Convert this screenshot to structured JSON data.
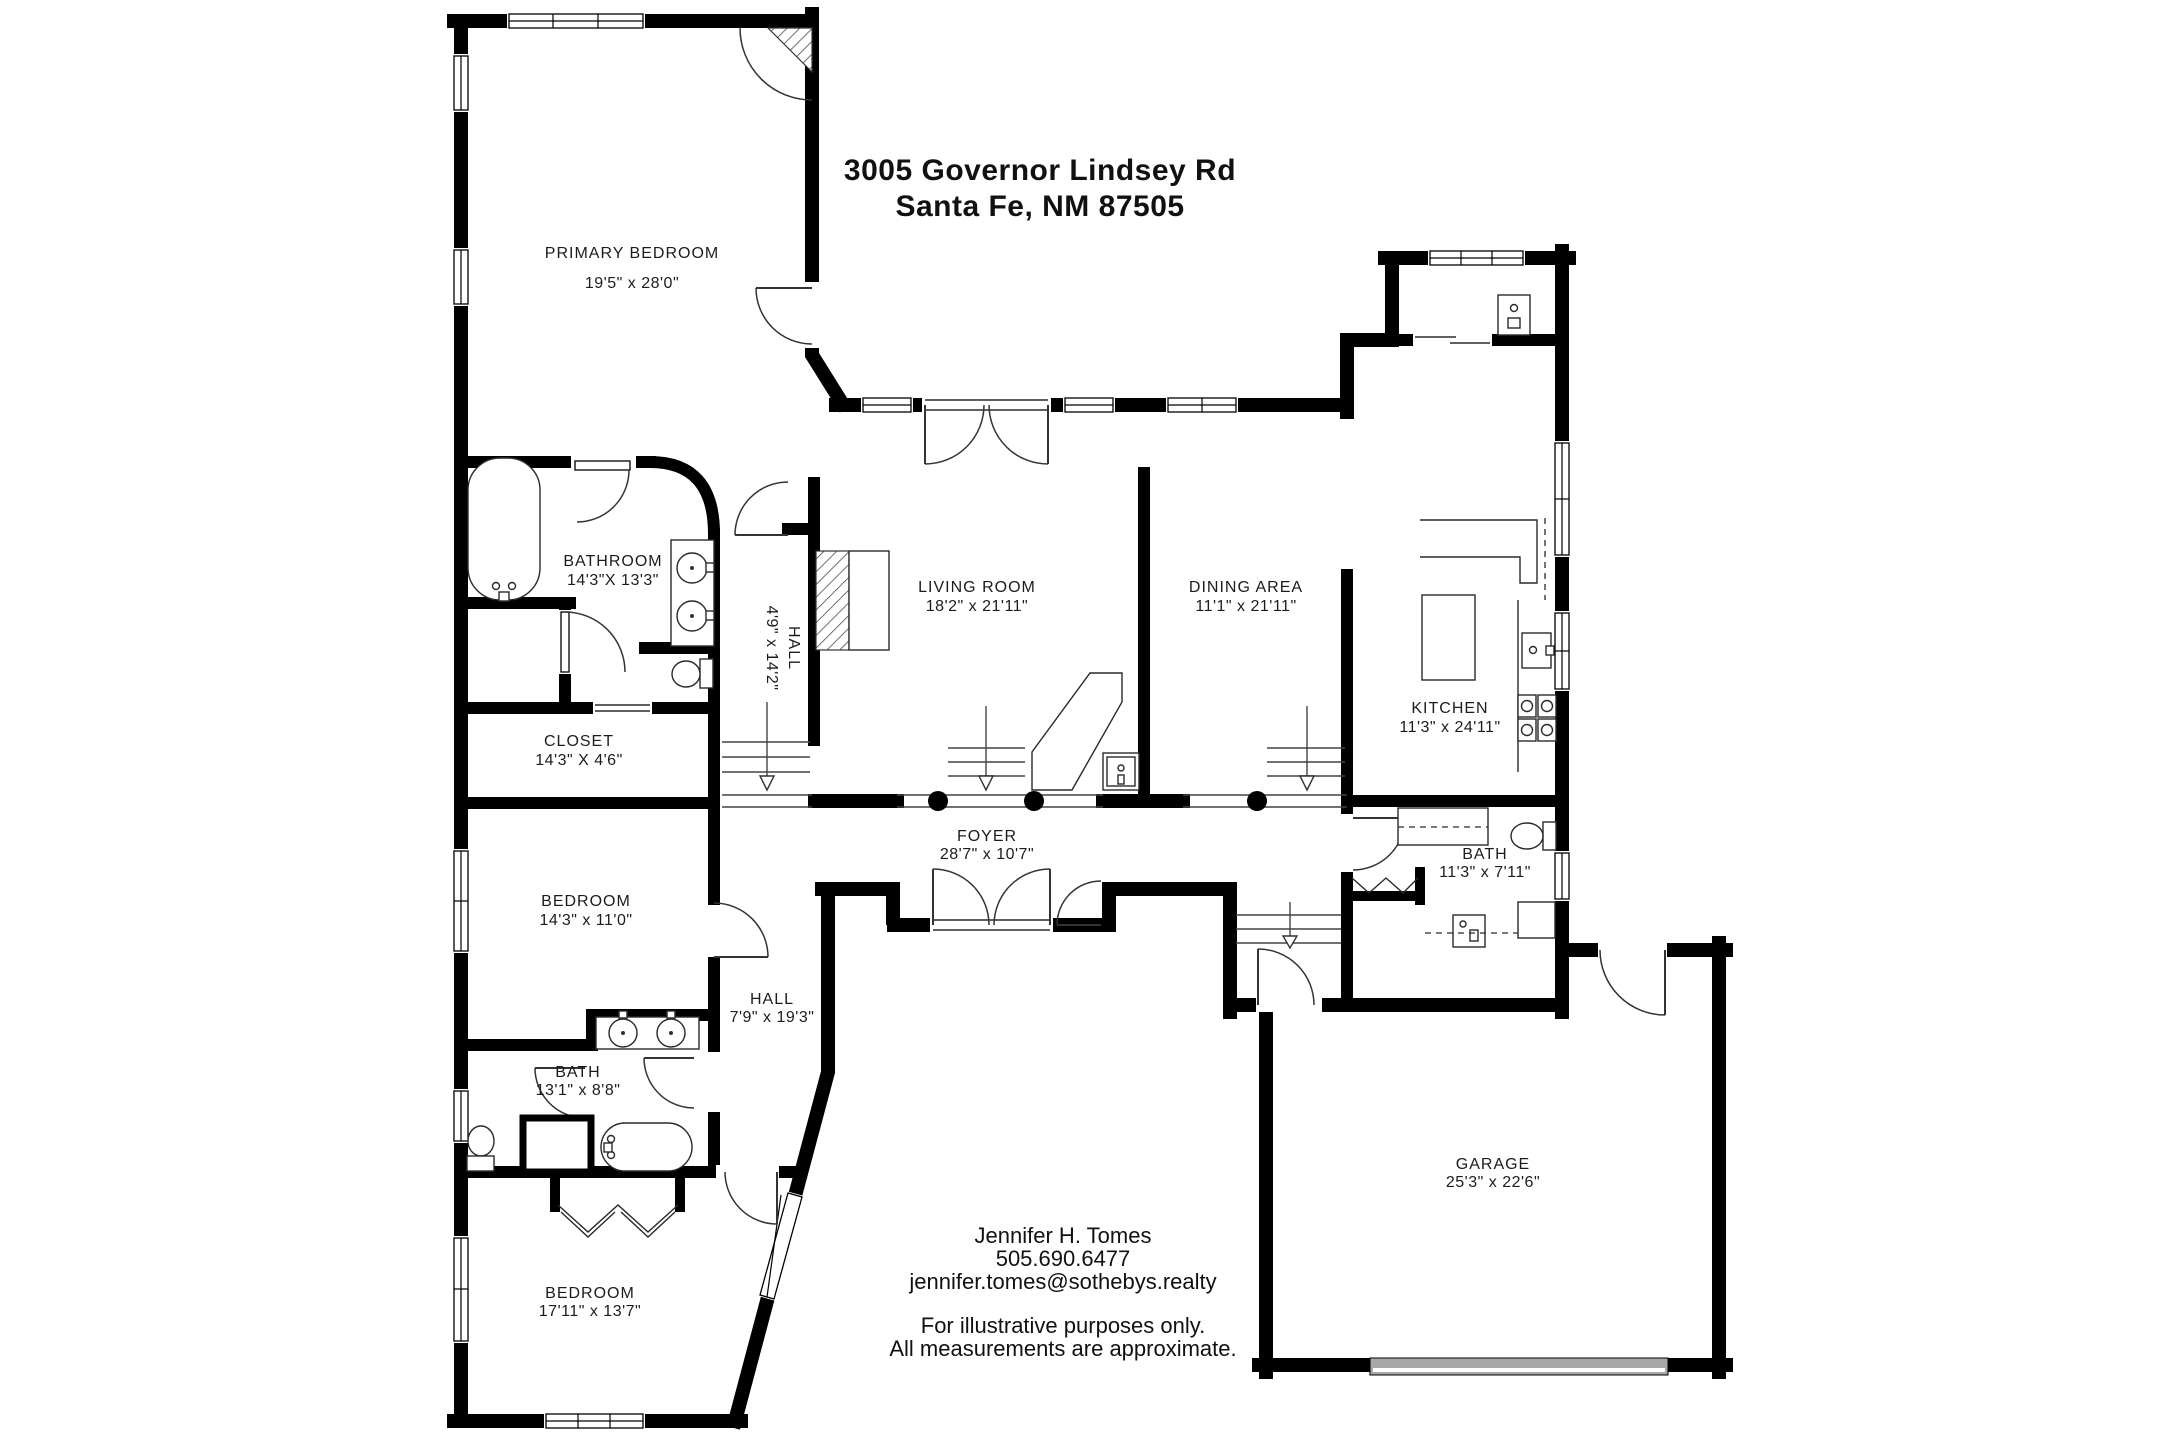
{
  "title": {
    "line1": "3005 Governor Lindsey Rd",
    "line2": "Santa Fe, NM 87505"
  },
  "rooms": {
    "primary_bedroom": {
      "name": "PRIMARY BEDROOM",
      "dims": "19'5\" x 28'0\""
    },
    "bathroom": {
      "name": "BATHROOM",
      "dims": "14'3\"X 13'3\""
    },
    "hall_upper": {
      "name": "HALL",
      "dims": "4'9\" x 14'2\""
    },
    "closet": {
      "name": "CLOSET",
      "dims": "14'3\" X 4'6\""
    },
    "bedroom_mid": {
      "name": "BEDROOM",
      "dims": "14'3\" x 11'0\""
    },
    "bath_mid": {
      "name": "BATH",
      "dims": "13'1\" x 8'8\""
    },
    "bedroom_lower": {
      "name": "BEDROOM",
      "dims": "17'11\" x 13'7\""
    },
    "hall_lower": {
      "name": "HALL",
      "dims": "7'9\" x 19'3\""
    },
    "foyer": {
      "name": "FOYER",
      "dims": "28'7\" x 10'7\""
    },
    "living_room": {
      "name": "LIVING ROOM",
      "dims": "18'2\" x 21'11\""
    },
    "dining_area": {
      "name": "DINING AREA",
      "dims": "11'1\" x 21'11\""
    },
    "kitchen": {
      "name": "KITCHEN",
      "dims": "11'3\" x 24'11\""
    },
    "bath_east": {
      "name": "BATH",
      "dims": "11'3\" x 7'11\""
    },
    "garage": {
      "name": "GARAGE",
      "dims": "25'3\" x 22'6\""
    }
  },
  "agent": {
    "name": "Jennifer H. Tomes",
    "phone": "505.690.6477",
    "email": "jennifer.tomes@sothebys.realty"
  },
  "disclaimer": {
    "line1": "For illustrative purposes only.",
    "line2": "All measurements are approximate."
  },
  "colors": {
    "wall": "#000000",
    "background": "#ffffff",
    "garage_door": "#a8a8a8",
    "text": "#111111"
  }
}
